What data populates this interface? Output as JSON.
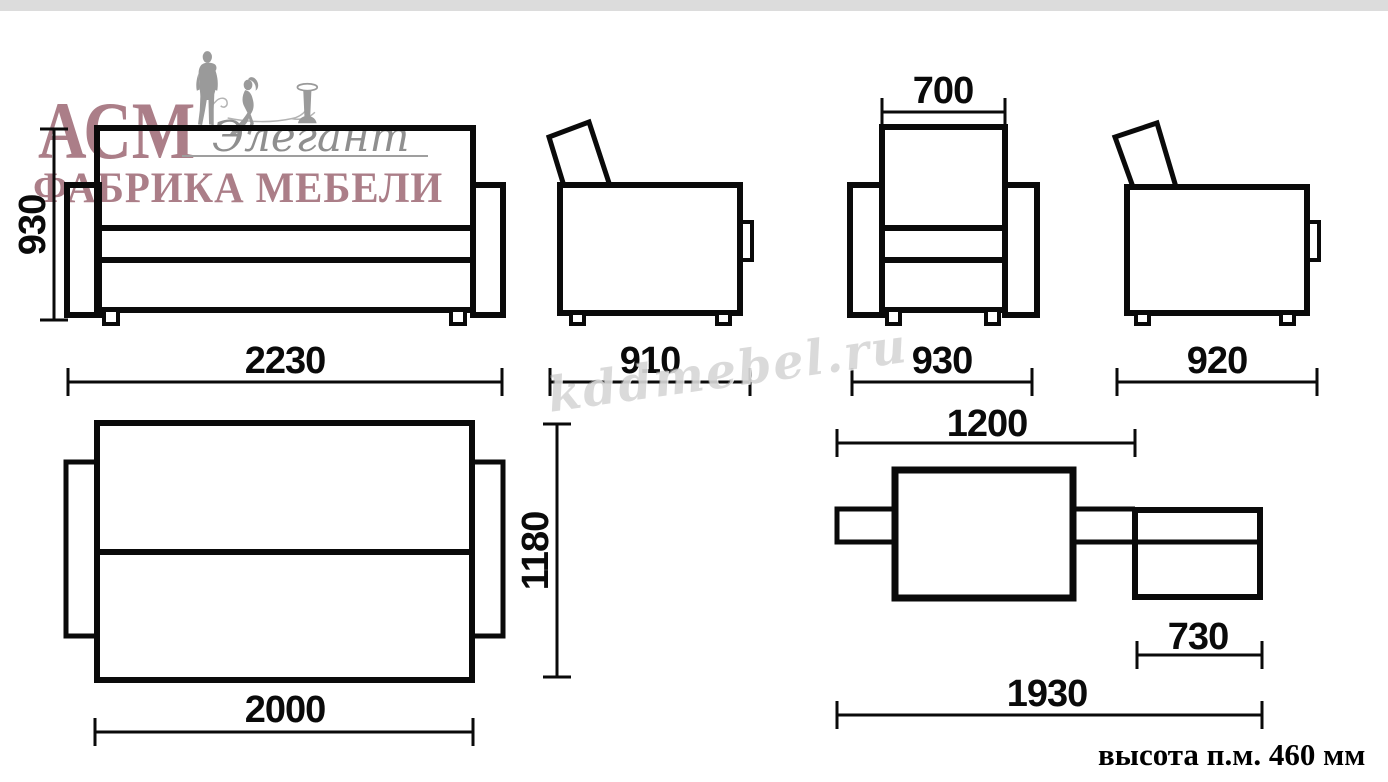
{
  "colors": {
    "brand_pink": "#ab7e88",
    "silhouette_gray": "#9a9a9a",
    "line_black": "#0a0a0a",
    "top_bar_gray": "#dcdcdc",
    "watermark_gray": "#acacac"
  },
  "logo": {
    "brand": "АСМ",
    "script": "Элегант",
    "subtitle": "ФАБРИКА МЕБЕЛИ"
  },
  "watermark": {
    "text": "kddmebel.ru"
  },
  "dimensions": {
    "sofa_front": {
      "height_mm": "930",
      "width_mm": "2230"
    },
    "sofa_side": {
      "depth_mm": "910"
    },
    "armchair_front": {
      "backrest_width_mm": "700",
      "width_mm": "930"
    },
    "armchair_side": {
      "depth_mm": "920"
    },
    "sleeping_top": {
      "width_mm": "1180",
      "length_mm": "2000"
    },
    "sleeping_side": {
      "main_section_mm": "1200",
      "ottoman_mm": "730",
      "total_length_mm": "1930"
    }
  },
  "note": {
    "sleeping_height": "высота п.м. 460 мм"
  }
}
